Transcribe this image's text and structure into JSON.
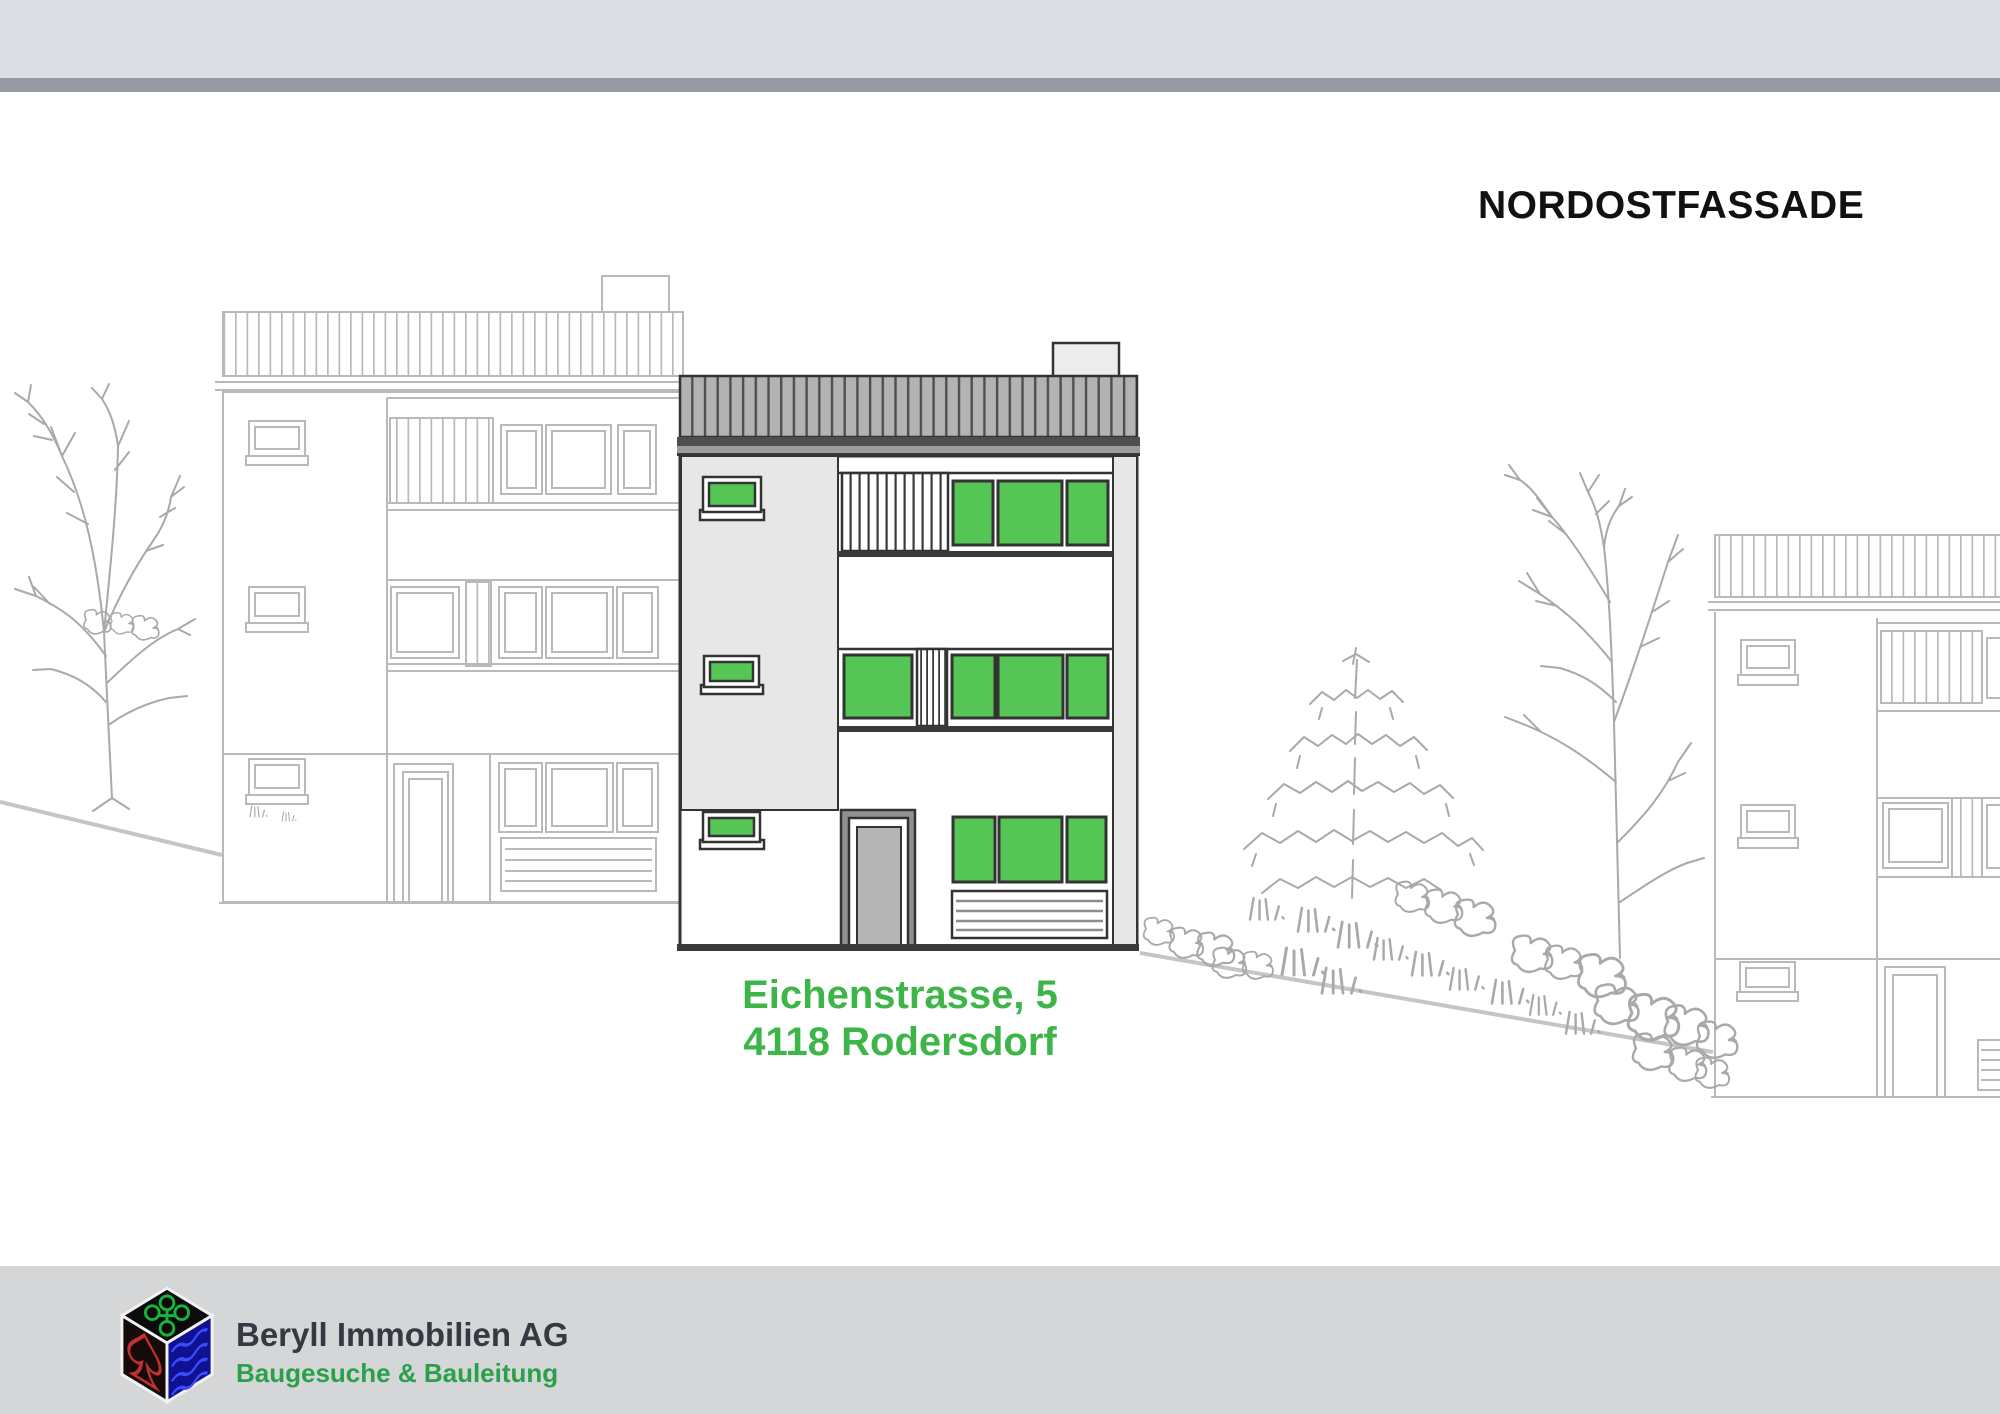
{
  "page": {
    "width": 2000,
    "height": 1414,
    "background": "#ffffff"
  },
  "title": {
    "text": "NORDOSTFASSADE"
  },
  "subject_label": {
    "line1": "Eichenstrasse, 5",
    "line2": "4118 Rodersdorf"
  },
  "footer": {
    "company": "Beryll Immobilien AG",
    "tagline": "Baugesuche & Bauleitung",
    "logo_icon": "cube-logo-icon"
  },
  "scene": {
    "type": "architectural elevation drawing",
    "subject": "three-storey house with striped flat roof, green-highlighted windows, entrance door and garage grille",
    "neighbors": [
      "outline elevation of left neighbor house",
      "outline elevation of right neighbor house (cropped at edge)"
    ],
    "vegetation": [
      "bare tree left",
      "spruce tree",
      "bare tree right",
      "shrubs along slope",
      "grass tufts"
    ],
    "terrain": [
      "ground line sloping at left",
      "ground line falling to the right"
    ]
  },
  "colors": {
    "header_band": "#dcdee3",
    "header_bar": "#969ba5",
    "footer_band": "#d5d6d8",
    "title_text": "#111111",
    "address_green": "#3eb549",
    "company_text": "#343a41",
    "tagline_green": "#2aa04b",
    "window_green": "#55c655",
    "subject_line": "#333333",
    "neighbor_line": "#b9b9b9",
    "panel_gray": "#e7e7e7",
    "door_gray": "#b5b5b5",
    "door_surround_gray": "#909090",
    "ground_line": "#c5c5c5",
    "vegetation_line": "#a9a9a9"
  }
}
